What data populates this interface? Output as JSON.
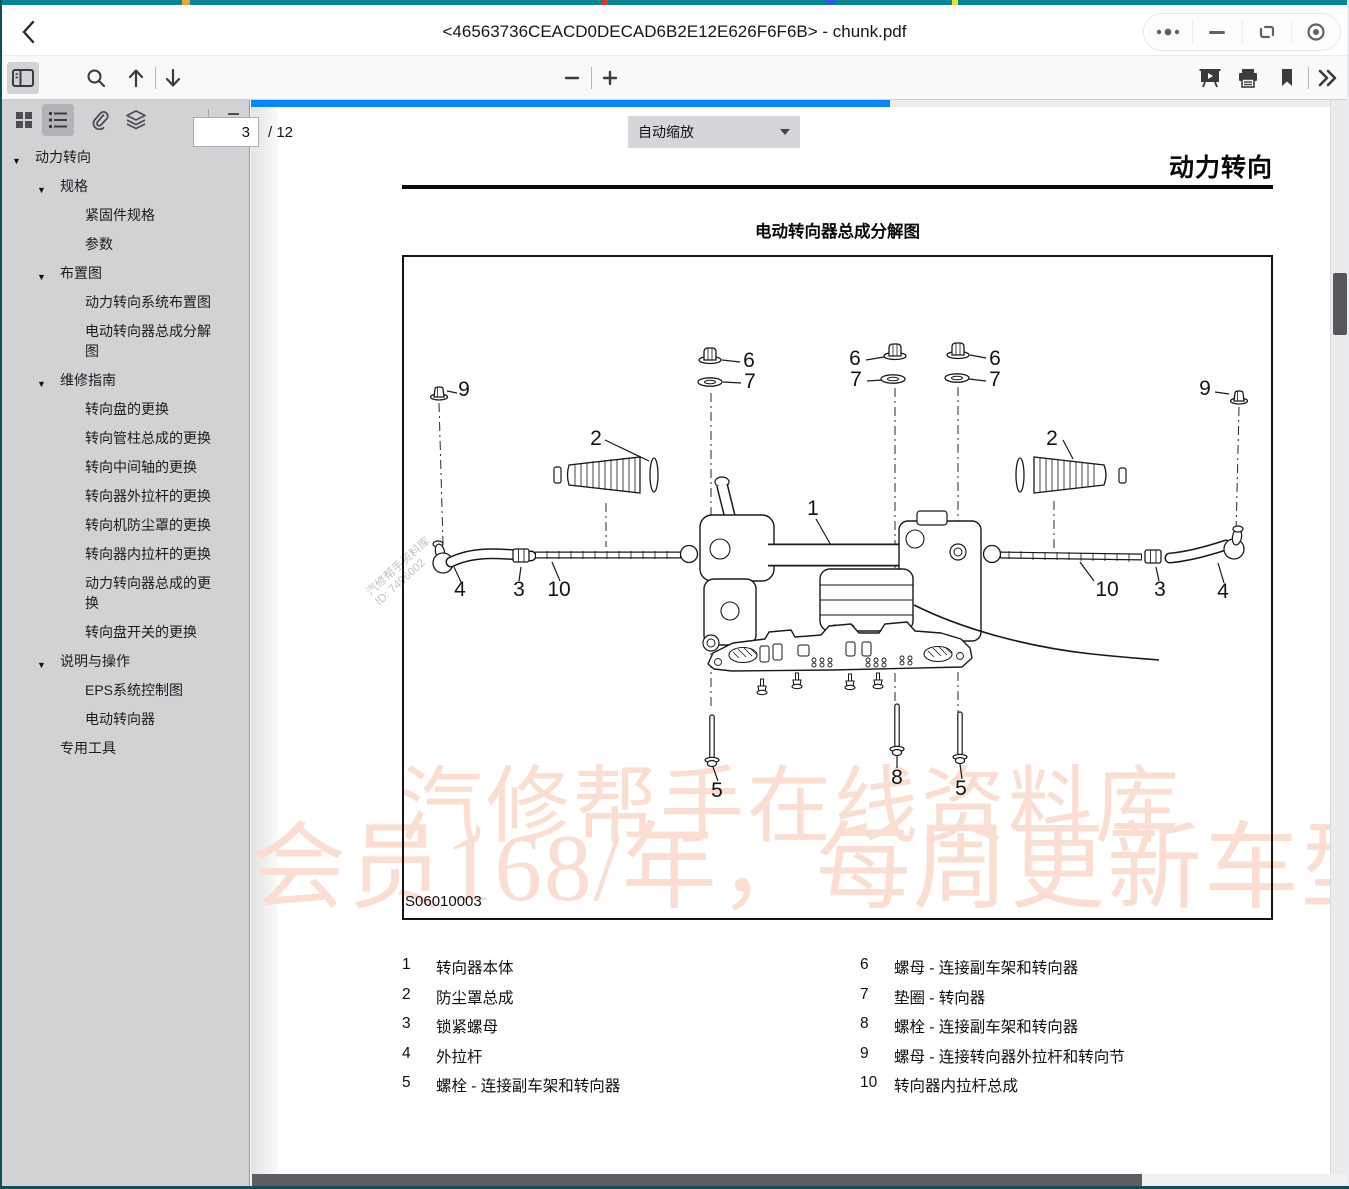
{
  "window": {
    "title": "<46563736CEACD0DECAD6B2E12E626F6F6B>  - chunk.pdf"
  },
  "toolbar": {
    "page_value": "3",
    "page_total": "/ 12",
    "zoom_value": "自动缩放"
  },
  "sidebar": {
    "items": [
      {
        "label": "动力转向",
        "level": 1,
        "caret": true
      },
      {
        "label": "规格",
        "level": 2,
        "caret": true
      },
      {
        "label": "紧固件规格",
        "level": 3,
        "caret": false
      },
      {
        "label": "参数",
        "level": 3,
        "caret": false
      },
      {
        "label": "布置图",
        "level": 2,
        "caret": true
      },
      {
        "label": "动力转向系统布置图",
        "level": 3,
        "caret": false
      },
      {
        "label": "电动转向器总成分解图",
        "level": 3,
        "caret": false
      },
      {
        "label": "维修指南",
        "level": 2,
        "caret": true
      },
      {
        "label": "转向盘的更换",
        "level": 3,
        "caret": false
      },
      {
        "label": "转向管柱总成的更换",
        "level": 3,
        "caret": false
      },
      {
        "label": "转向中间轴的更换",
        "level": 3,
        "caret": false
      },
      {
        "label": "转向器外拉杆的更换",
        "level": 3,
        "caret": false
      },
      {
        "label": "转向机防尘罩的更换",
        "level": 3,
        "caret": false
      },
      {
        "label": "转向器内拉杆的更换",
        "level": 3,
        "caret": false
      },
      {
        "label": "动力转向器总成的更换",
        "level": 3,
        "caret": false
      },
      {
        "label": "转向盘开关的更换",
        "level": 3,
        "caret": false
      },
      {
        "label": "说明与操作",
        "level": 2,
        "caret": true
      },
      {
        "label": "EPS系统控制图",
        "level": 3,
        "caret": false
      },
      {
        "label": "电动转向器",
        "level": 3,
        "caret": false
      },
      {
        "label": "专用工具",
        "level": 2,
        "caret": false
      }
    ]
  },
  "page": {
    "chapter_title": "动力转向",
    "figure_title": "电动转向器总成分解图",
    "figure_code": "S06010003",
    "watermark_line1": "汽修帮手在线资料库",
    "watermark_line2": "会员168/年，每周更新车型",
    "wm_small_1": "汽修帮手资料库",
    "wm_small_2": "ID: 7496002",
    "parts_left": [
      {
        "num": "1",
        "label": "转向器本体"
      },
      {
        "num": "2",
        "label": "防尘罩总成"
      },
      {
        "num": "3",
        "label": "锁紧螺母"
      },
      {
        "num": "4",
        "label": "外拉杆"
      },
      {
        "num": "5",
        "label": "螺栓 - 连接副车架和转向器"
      }
    ],
    "parts_right": [
      {
        "num": "6",
        "label": "螺母 - 连接副车架和转向器"
      },
      {
        "num": "7",
        "label": "垫圈 - 转向器"
      },
      {
        "num": "8",
        "label": "螺栓 - 连接副车架和转向器"
      },
      {
        "num": "9",
        "label": "螺母 - 连接转向器外拉杆和转向节"
      },
      {
        "num": "10",
        "label": "转向器内拉杆总成"
      }
    ],
    "callouts": [
      {
        "n": "9",
        "x": 62,
        "y": 141
      },
      {
        "n": "2",
        "x": 194,
        "y": 190
      },
      {
        "n": "6",
        "x": 347,
        "y": 112
      },
      {
        "n": "7",
        "x": 348,
        "y": 133
      },
      {
        "n": "6",
        "x": 453,
        "y": 110
      },
      {
        "n": "7",
        "x": 454,
        "y": 131
      },
      {
        "n": "6",
        "x": 593,
        "y": 110
      },
      {
        "n": "7",
        "x": 593,
        "y": 131
      },
      {
        "n": "2",
        "x": 650,
        "y": 190
      },
      {
        "n": "9",
        "x": 803,
        "y": 140
      },
      {
        "n": "1",
        "x": 411,
        "y": 260
      },
      {
        "n": "4",
        "x": 58,
        "y": 341
      },
      {
        "n": "3",
        "x": 117,
        "y": 341
      },
      {
        "n": "10",
        "x": 157,
        "y": 341
      },
      {
        "n": "10",
        "x": 705,
        "y": 341
      },
      {
        "n": "3",
        "x": 758,
        "y": 341
      },
      {
        "n": "4",
        "x": 821,
        "y": 343
      },
      {
        "n": "5",
        "x": 315,
        "y": 542
      },
      {
        "n": "8",
        "x": 495,
        "y": 529
      },
      {
        "n": "5",
        "x": 559,
        "y": 540
      }
    ]
  },
  "colors": {
    "accent_blue": "#0a84ff",
    "watermark_pink": "#f9ded1",
    "window_edge_teal": "#078593",
    "sidebar_gray": "#d2d2d5"
  }
}
